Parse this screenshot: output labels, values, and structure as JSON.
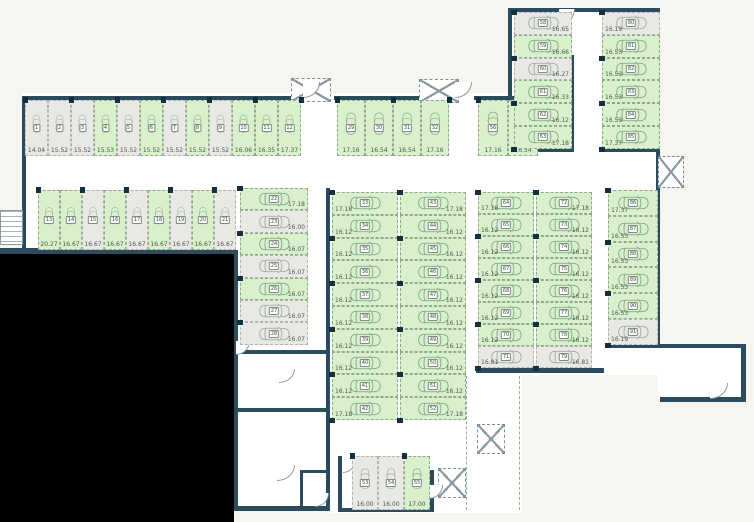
{
  "colors": {
    "available": "#d8f0cb",
    "occupied": "#e8e8e4",
    "wall": "#2b4c5e",
    "void": "#000000"
  },
  "groups": {
    "top_row": {
      "label": "spaces 1-12",
      "spaces": [
        {
          "num": "1",
          "area": "14.04",
          "status": "occupied"
        },
        {
          "num": "2",
          "area": "15.52",
          "status": "occupied"
        },
        {
          "num": "3",
          "area": "15.52",
          "status": "occupied"
        },
        {
          "num": "4",
          "area": "15.53",
          "status": "available"
        },
        {
          "num": "5",
          "area": "15.52",
          "status": "occupied"
        },
        {
          "num": "6",
          "area": "15.52",
          "status": "available"
        },
        {
          "num": "7",
          "area": "15.52",
          "status": "occupied"
        },
        {
          "num": "8",
          "area": "15.52",
          "status": "available"
        },
        {
          "num": "9",
          "area": "15.52",
          "status": "occupied"
        },
        {
          "num": "10",
          "area": "16.06",
          "status": "available"
        },
        {
          "num": "11",
          "area": "16.35",
          "status": "available"
        },
        {
          "num": "12",
          "area": "17.37",
          "status": "available"
        }
      ]
    },
    "second_row": {
      "label": "spaces 13-21",
      "spaces": [
        {
          "num": "13",
          "area": "20.27",
          "status": "available"
        },
        {
          "num": "14",
          "area": "16.67",
          "status": "available"
        },
        {
          "num": "15",
          "area": "16.67",
          "status": "occupied"
        },
        {
          "num": "16",
          "area": "16.67",
          "status": "available"
        },
        {
          "num": "17",
          "area": "16.67",
          "status": "occupied"
        },
        {
          "num": "18",
          "area": "16.67",
          "status": "available"
        },
        {
          "num": "19",
          "area": "16.67",
          "status": "occupied"
        },
        {
          "num": "20",
          "area": "16.67",
          "status": "available"
        },
        {
          "num": "21",
          "area": "16.67",
          "status": "occupied"
        }
      ]
    },
    "left_col": {
      "label": "spaces 22-28",
      "spaces": [
        {
          "num": "22",
          "area": "17.18",
          "status": "available"
        },
        {
          "num": "23",
          "area": "16.00",
          "status": "occupied"
        },
        {
          "num": "24",
          "area": "16.07",
          "status": "available"
        },
        {
          "num": "25",
          "area": "16.07",
          "status": "occupied"
        },
        {
          "num": "26",
          "area": "16.07",
          "status": "available"
        },
        {
          "num": "27",
          "area": "16.07",
          "status": "occupied"
        },
        {
          "num": "28",
          "area": "16.07",
          "status": "occupied"
        }
      ]
    },
    "mid_top": {
      "label": "spaces 29-32",
      "spaces": [
        {
          "num": "29",
          "area": "17.16",
          "status": "available"
        },
        {
          "num": "30",
          "area": "16.54",
          "status": "available"
        },
        {
          "num": "31",
          "area": "16.54",
          "status": "available"
        },
        {
          "num": "32",
          "area": "17.16",
          "status": "available"
        }
      ]
    },
    "mid_left_col": {
      "label": "spaces 33-42",
      "spaces": [
        {
          "num": "33",
          "area": "17.18",
          "status": "available"
        },
        {
          "num": "34",
          "area": "16.12",
          "status": "available"
        },
        {
          "num": "35",
          "area": "16.12",
          "status": "available"
        },
        {
          "num": "36",
          "area": "16.12",
          "status": "available"
        },
        {
          "num": "37",
          "area": "16.12",
          "status": "available"
        },
        {
          "num": "38",
          "area": "16.12",
          "status": "available"
        },
        {
          "num": "39",
          "area": "16.12",
          "status": "available"
        },
        {
          "num": "40",
          "area": "16.12",
          "status": "available"
        },
        {
          "num": "41",
          "area": "16.12",
          "status": "available"
        },
        {
          "num": "42",
          "area": "17.18",
          "status": "available"
        }
      ]
    },
    "mid_right_col": {
      "label": "spaces 43-52",
      "spaces": [
        {
          "num": "43",
          "area": "17.18",
          "status": "available"
        },
        {
          "num": "44",
          "area": "16.12",
          "status": "available"
        },
        {
          "num": "45",
          "area": "16.12",
          "status": "available"
        },
        {
          "num": "46",
          "area": "16.12",
          "status": "available"
        },
        {
          "num": "47",
          "area": "16.12",
          "status": "available"
        },
        {
          "num": "48",
          "area": "16.12",
          "status": "available"
        },
        {
          "num": "49",
          "area": "16.12",
          "status": "available"
        },
        {
          "num": "50",
          "area": "16.12",
          "status": "available"
        },
        {
          "num": "51",
          "area": "16.12",
          "status": "available"
        },
        {
          "num": "52",
          "area": "17.18",
          "status": "available"
        }
      ]
    },
    "bottom_center": {
      "label": "spaces 53-55",
      "spaces": [
        {
          "num": "53",
          "area": "16.00",
          "status": "occupied"
        },
        {
          "num": "54",
          "area": "16.00",
          "status": "occupied"
        },
        {
          "num": "55",
          "area": "17.00",
          "status": "available"
        }
      ]
    },
    "upper_mid_pair": {
      "label": "spaces 56-57",
      "spaces": [
        {
          "num": "56",
          "area": "17.16",
          "status": "available"
        },
        {
          "num": "57",
          "area": "16.54",
          "status": "available"
        }
      ]
    },
    "ne_left_col": {
      "label": "spaces 58-63",
      "spaces": [
        {
          "num": "58",
          "area": "16.65",
          "status": "occupied"
        },
        {
          "num": "59",
          "area": "16.66",
          "status": "available"
        },
        {
          "num": "60",
          "area": "16.27",
          "status": "occupied"
        },
        {
          "num": "61",
          "area": "16.33",
          "status": "available"
        },
        {
          "num": "62",
          "area": "16.12",
          "status": "available"
        },
        {
          "num": "63",
          "area": "17.18",
          "status": "available"
        }
      ]
    },
    "ne_right_col": {
      "label": "spaces 80-85",
      "spaces": [
        {
          "num": "80",
          "area": "16.19",
          "status": "occupied"
        },
        {
          "num": "81",
          "area": "16.53",
          "status": "available"
        },
        {
          "num": "82",
          "area": "16.53",
          "status": "available"
        },
        {
          "num": "83",
          "area": "16.53",
          "status": "available"
        },
        {
          "num": "84",
          "area": "16.53",
          "status": "available"
        },
        {
          "num": "85",
          "area": "17.37",
          "status": "available"
        }
      ]
    },
    "east_left_col": {
      "label": "spaces 64-71",
      "spaces": [
        {
          "num": "64",
          "area": "17.18",
          "status": "available"
        },
        {
          "num": "65",
          "area": "16.12",
          "status": "available"
        },
        {
          "num": "66",
          "area": "16.12",
          "status": "available"
        },
        {
          "num": "67",
          "area": "16.12",
          "status": "available"
        },
        {
          "num": "68",
          "area": "16.12",
          "status": "available"
        },
        {
          "num": "69",
          "area": "16.12",
          "status": "available"
        },
        {
          "num": "70",
          "area": "16.12",
          "status": "available"
        },
        {
          "num": "71",
          "area": "16.81",
          "status": "occupied"
        }
      ]
    },
    "east_right_col": {
      "label": "spaces 72-79",
      "spaces": [
        {
          "num": "72",
          "area": "17.18",
          "status": "available"
        },
        {
          "num": "73",
          "area": "16.12",
          "status": "available"
        },
        {
          "num": "74",
          "area": "16.12",
          "status": "available"
        },
        {
          "num": "75",
          "area": "16.12",
          "status": "available"
        },
        {
          "num": "76",
          "area": "16.12",
          "status": "available"
        },
        {
          "num": "77",
          "area": "16.12",
          "status": "available"
        },
        {
          "num": "78",
          "area": "16.12",
          "status": "available"
        },
        {
          "num": "79",
          "area": "16.81",
          "status": "occupied"
        }
      ]
    },
    "far_east_col": {
      "label": "spaces 86-91",
      "spaces": [
        {
          "num": "86",
          "area": "17.37",
          "status": "available"
        },
        {
          "num": "87",
          "area": "16.53",
          "status": "available"
        },
        {
          "num": "88",
          "area": "16.53",
          "status": "available"
        },
        {
          "num": "89",
          "area": "16.53",
          "status": "available"
        },
        {
          "num": "90",
          "area": "16.53",
          "status": "available"
        },
        {
          "num": "91",
          "area": "16.19",
          "status": "occupied"
        }
      ]
    }
  }
}
